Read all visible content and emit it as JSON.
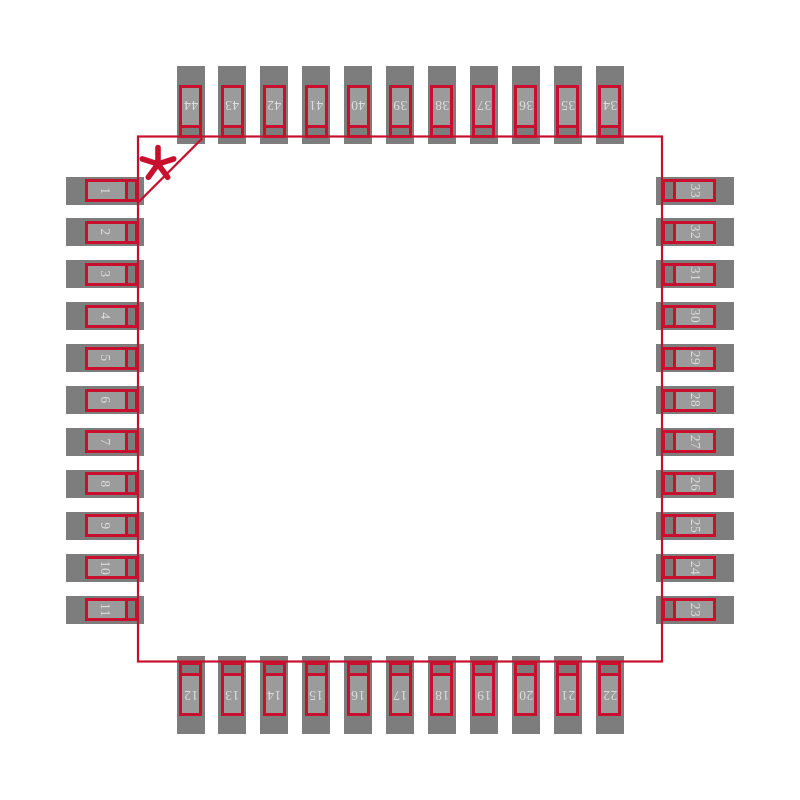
{
  "figure": {
    "description": "44-pin quad flat package (QFP) land pattern footprint diagram",
    "total_pins": 44,
    "pin1_marker": "*",
    "colors": {
      "background": "#ffffff",
      "outline_red": "#c8102e",
      "pad_gray": "#7d7d7d",
      "lead_fill_gray": "#9b9b9b",
      "pin_number_text": "#dcdcdc"
    },
    "sides": {
      "left": {
        "order": "top-to-bottom",
        "pins": [
          "1",
          "2",
          "3",
          "4",
          "5",
          "6",
          "7",
          "8",
          "9",
          "10",
          "11"
        ]
      },
      "bottom": {
        "order": "left-to-right",
        "pins": [
          "12",
          "13",
          "14",
          "15",
          "16",
          "17",
          "18",
          "19",
          "20",
          "21",
          "22"
        ]
      },
      "right": {
        "order": "top-to-bottom",
        "pins": [
          "33",
          "32",
          "31",
          "30",
          "29",
          "28",
          "27",
          "26",
          "25",
          "24",
          "23"
        ]
      },
      "top": {
        "order": "left-to-right",
        "pins": [
          "44",
          "43",
          "42",
          "41",
          "40",
          "39",
          "38",
          "37",
          "36",
          "35",
          "34"
        ]
      }
    }
  }
}
